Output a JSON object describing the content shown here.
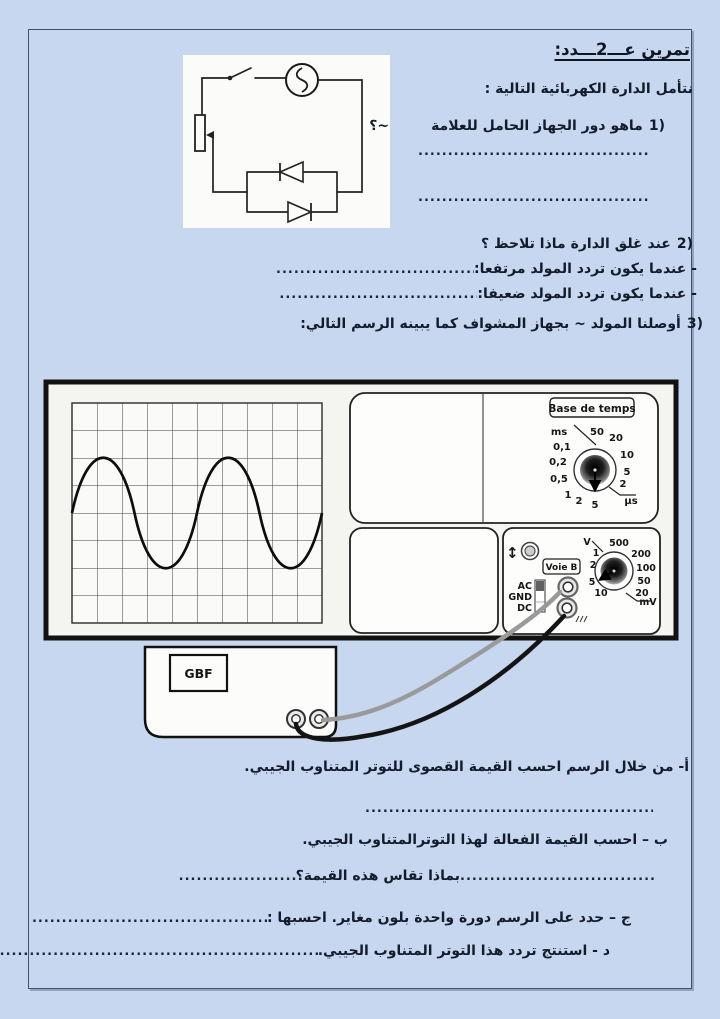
{
  "page": {
    "bg": "#c7d7ef",
    "text_color": "#121c2b"
  },
  "title": "تمرين عـــ2ـــدد:",
  "intro": "نتأمل الدارة الكهربائية التالية :",
  "questions": {
    "q1": {
      "num": "1)",
      "text": "ماهو دور الجهاز الحامل للعلامة",
      "tail": "~؟"
    },
    "q2": {
      "num": "2)",
      "text": "عند غلق الدارة ماذا تلاحظ ؟"
    },
    "q2a": "- عندما يكون تردد المولد مرتفعا:",
    "q2b": "- عندما يكون تردد المولد ضعيفا:",
    "q3": {
      "num": "3)",
      "text": "أوصلنا المولد ~ بجهاز المشواف كما يبينه الرسم التالي:"
    },
    "qa": "أ- من خلال الرسم احسب القيمة القصوى للتوتر المتناوب الجيبي.",
    "qb": "ب – احسب القيمة الفعالة لهذا التوترالمتناوب الجيبي.",
    "qb2": "بماذا تقاس هذه القيمة؟",
    "qc": "ج – حدد على الرسم دورة واحدة بلون مغاير.  احسبها :",
    "qd": "د - استنتج تردد هذا التوتر المتناوب الجيبي."
  },
  "dots": {
    "fill": "......................................................................................................................................"
  },
  "figure": {
    "screen": {
      "divisions_x": 10,
      "divisions_y": 8,
      "amplitude_divisions": 2,
      "period_divisions": 5,
      "waveform": "sine"
    },
    "osc": {
      "base_de_temps_label": "Base de temps",
      "time_labels": [
        "ms",
        "0,1",
        "0,2",
        "0,5",
        "1",
        "2",
        "5",
        "2",
        "5",
        "10",
        "20",
        "50",
        "µs"
      ],
      "voie_b_label": "Voie B",
      "coupling": [
        "AC",
        "GND",
        "DC"
      ],
      "volt_labels": [
        "V",
        "1",
        "2",
        "5",
        "10",
        "500",
        "200",
        "100",
        "50",
        "20",
        "mV"
      ],
      "updown": "↕"
    },
    "gbf_label": "GBF"
  }
}
